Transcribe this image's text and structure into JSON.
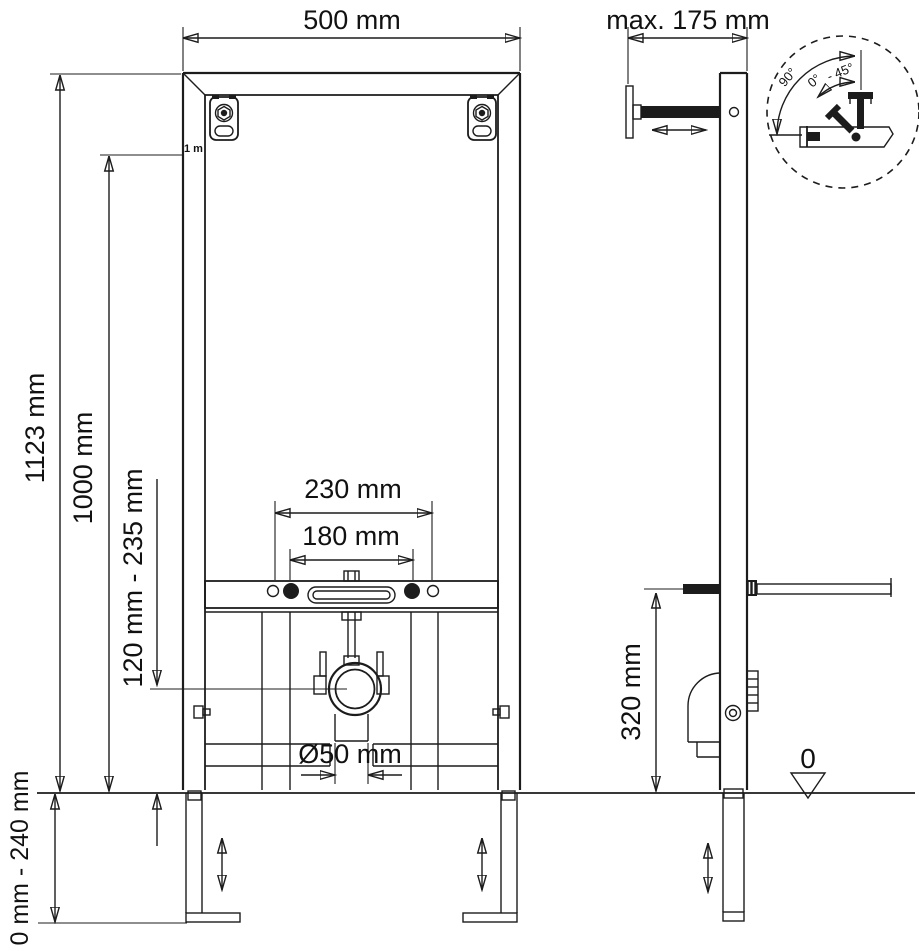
{
  "drawing": {
    "front_view": {
      "width_label": "500 mm",
      "total_height_label": "1123 mm",
      "height_1000_label": "1000 mm",
      "one_meter_mark": "1 m",
      "fixing_230_label": "230 mm",
      "fixing_180_label": "180 mm",
      "outlet_height_label": "120 mm - 235 mm",
      "outlet_diameter_label": "Ø50 mm",
      "foot_adjust_label": "0 mm - 240 mm"
    },
    "side_view": {
      "depth_label": "max. 175 mm",
      "inlet_height_label": "320 mm",
      "floor_datum_label": "0"
    },
    "detail_view": {
      "angle_90_label": "90°",
      "angle_0_label": "0°",
      "angle_45_label": "- 45°"
    }
  }
}
